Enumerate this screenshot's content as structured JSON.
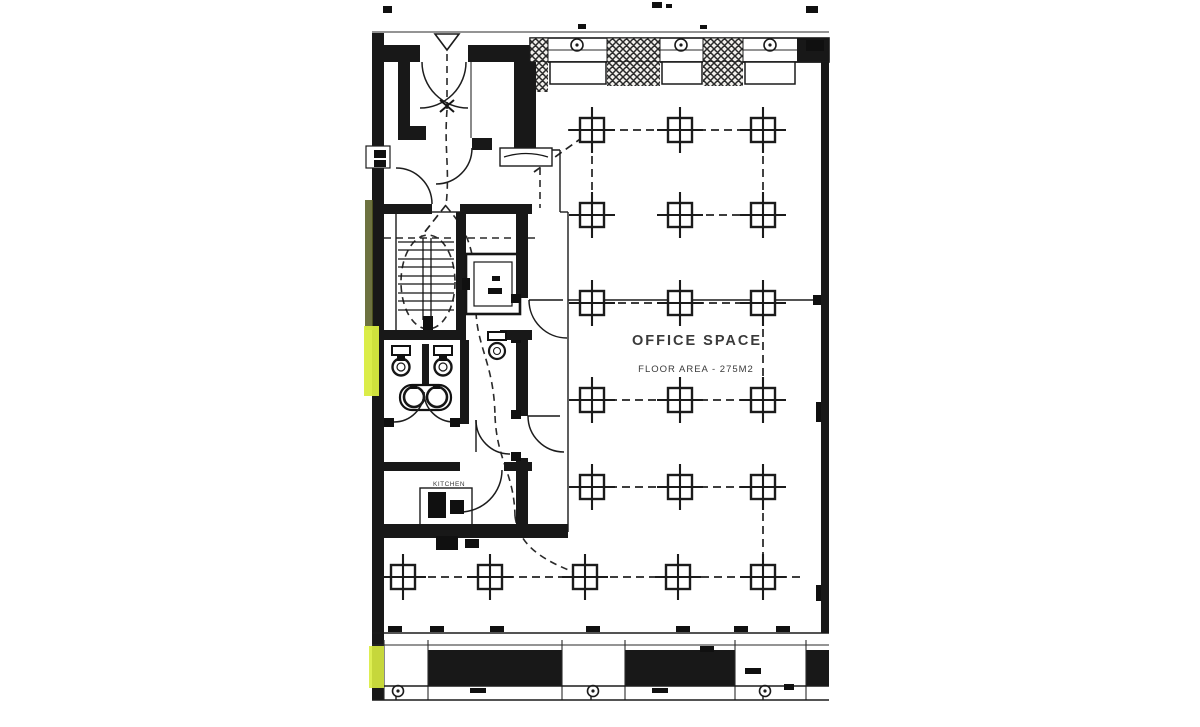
{
  "meta": {
    "paper_color": "#ffffff",
    "ink_color": "#1b1b1b",
    "highlight_color": "#d9ec3f",
    "shade_color": "#53591f"
  },
  "labels": {
    "office_title": "OFFICE SPACE",
    "office_area": "FLOOR AREA - 275M2",
    "kitchen": "KITCHEN"
  },
  "column_grid": {
    "square_half": 12,
    "arm_half": 23,
    "office_columns": {
      "xs": [
        592,
        680,
        763
      ],
      "ys": [
        130,
        215,
        303,
        400,
        487
      ]
    },
    "lower_row": {
      "y": 577,
      "xs": [
        403,
        490,
        585,
        678,
        763
      ]
    }
  },
  "window_symbols": {
    "top": {
      "y": 45,
      "xs": [
        577,
        681,
        770
      ],
      "radius": 6
    },
    "bottom": {
      "y": 691,
      "xs": [
        398,
        593,
        765
      ],
      "radius": 5.5
    }
  }
}
